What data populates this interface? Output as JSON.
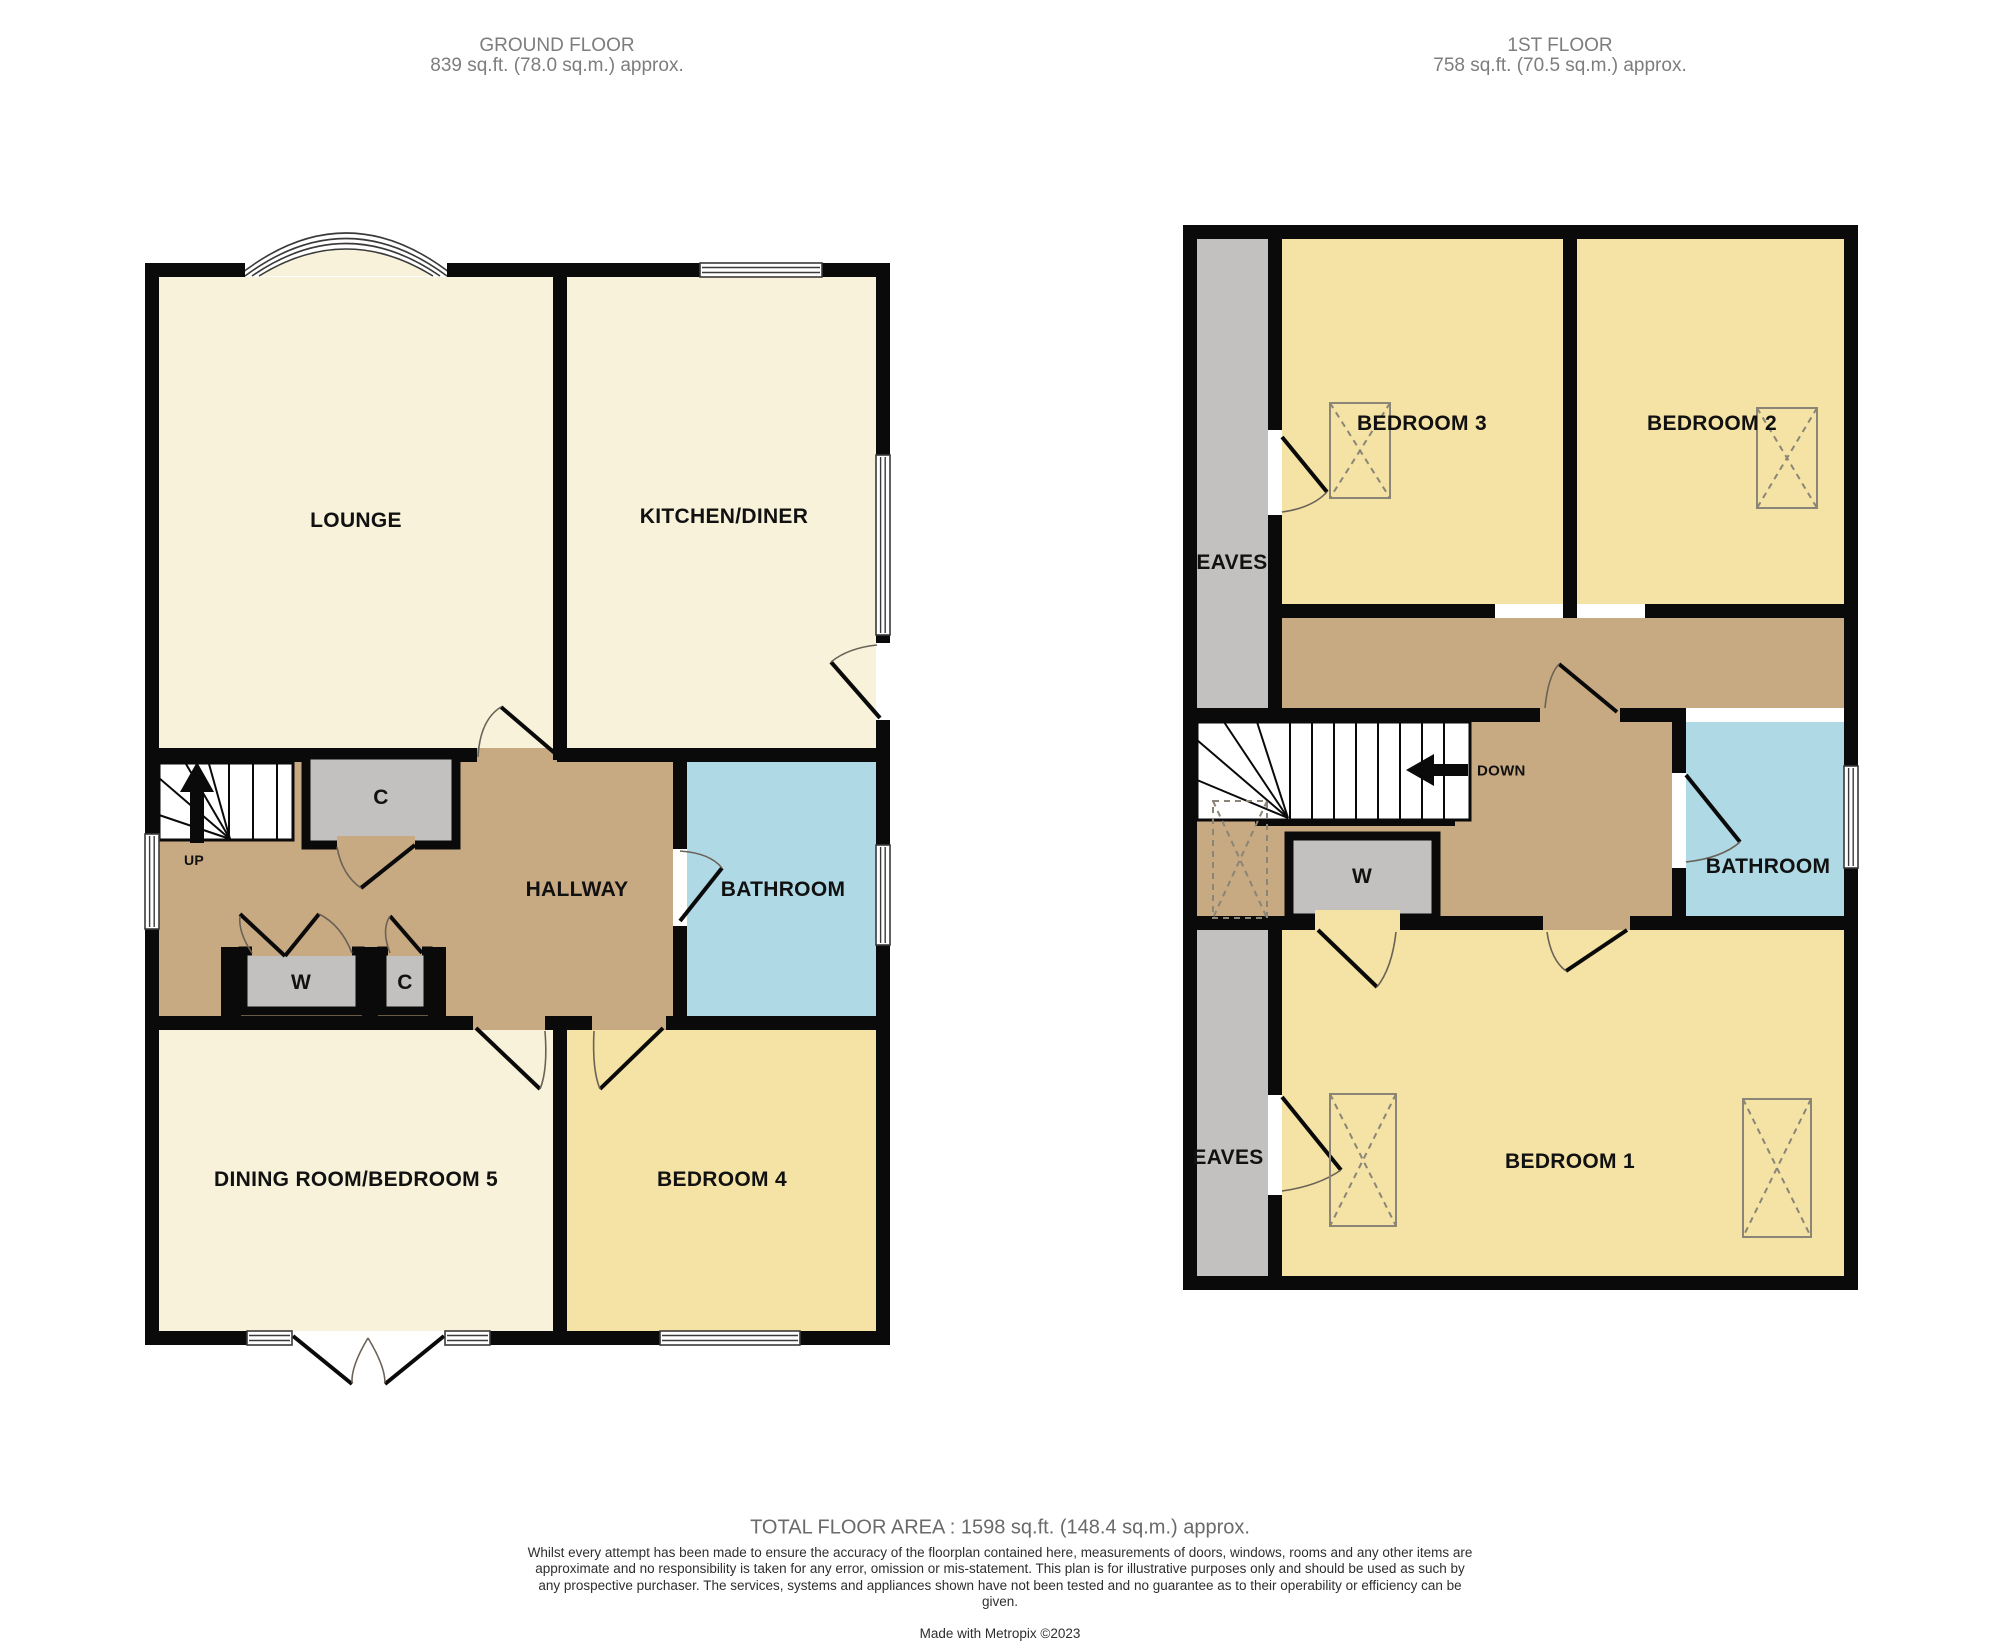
{
  "ground_floor": {
    "title": "GROUND FLOOR",
    "area": "839 sq.ft. (78.0 sq.m.) approx.",
    "rooms": {
      "lounge": "LOUNGE",
      "kitchen_diner": "KITCHEN/DINER",
      "hallway": "HALLWAY",
      "bathroom": "BATHROOM",
      "dining": "DINING ROOM/BEDROOM 5",
      "bedroom4": "BEDROOM 4",
      "cupboard": "C",
      "wardrobe": "W",
      "cupboard2": "C",
      "stairs_up": "UP"
    }
  },
  "first_floor": {
    "title": "1ST FLOOR",
    "area": "758 sq.ft. (70.5 sq.m.) approx.",
    "rooms": {
      "bedroom1": "BEDROOM 1",
      "bedroom2": "BEDROOM 2",
      "bedroom3": "BEDROOM 3",
      "bathroom": "BATHROOM",
      "wardrobe": "W",
      "eaves_top": "EAVES",
      "eaves_bottom": "EAVES",
      "stairs_down": "DOWN"
    }
  },
  "footer": {
    "total_area": "TOTAL FLOOR AREA : 1598 sq.ft. (148.4 sq.m.) approx.",
    "disclaimer": "Whilst every attempt has been made to ensure the accuracy of the floorplan contained here, measurements of doors, windows, rooms and any other items are approximate and no responsibility is taken for any error, omission or mis-statement. This plan is for illustrative purposes only and should be used as such by any prospective purchaser. The services, systems and appliances shown have not been tested and no guarantee as to their operability or efficiency can be given.",
    "credit": "Made with Metropix ©2023"
  },
  "colors": {
    "room_cream": "#F7F2D9",
    "room_yellow": "#F4E3A4",
    "hallway_tan": "#C7A982",
    "cupboard_gray": "#C2C1BF",
    "bathroom_blue": "#AED9E5",
    "wall": "#0A0A0A",
    "window_line": "#3A3A3A",
    "door_arc": "#6B6257",
    "wardrobe_line": "#8B8577",
    "title_gray": "#7D7D7D",
    "footer_gray": "#6A6A6A",
    "disclaimer": "#2E2E2E",
    "label": "#111111"
  }
}
